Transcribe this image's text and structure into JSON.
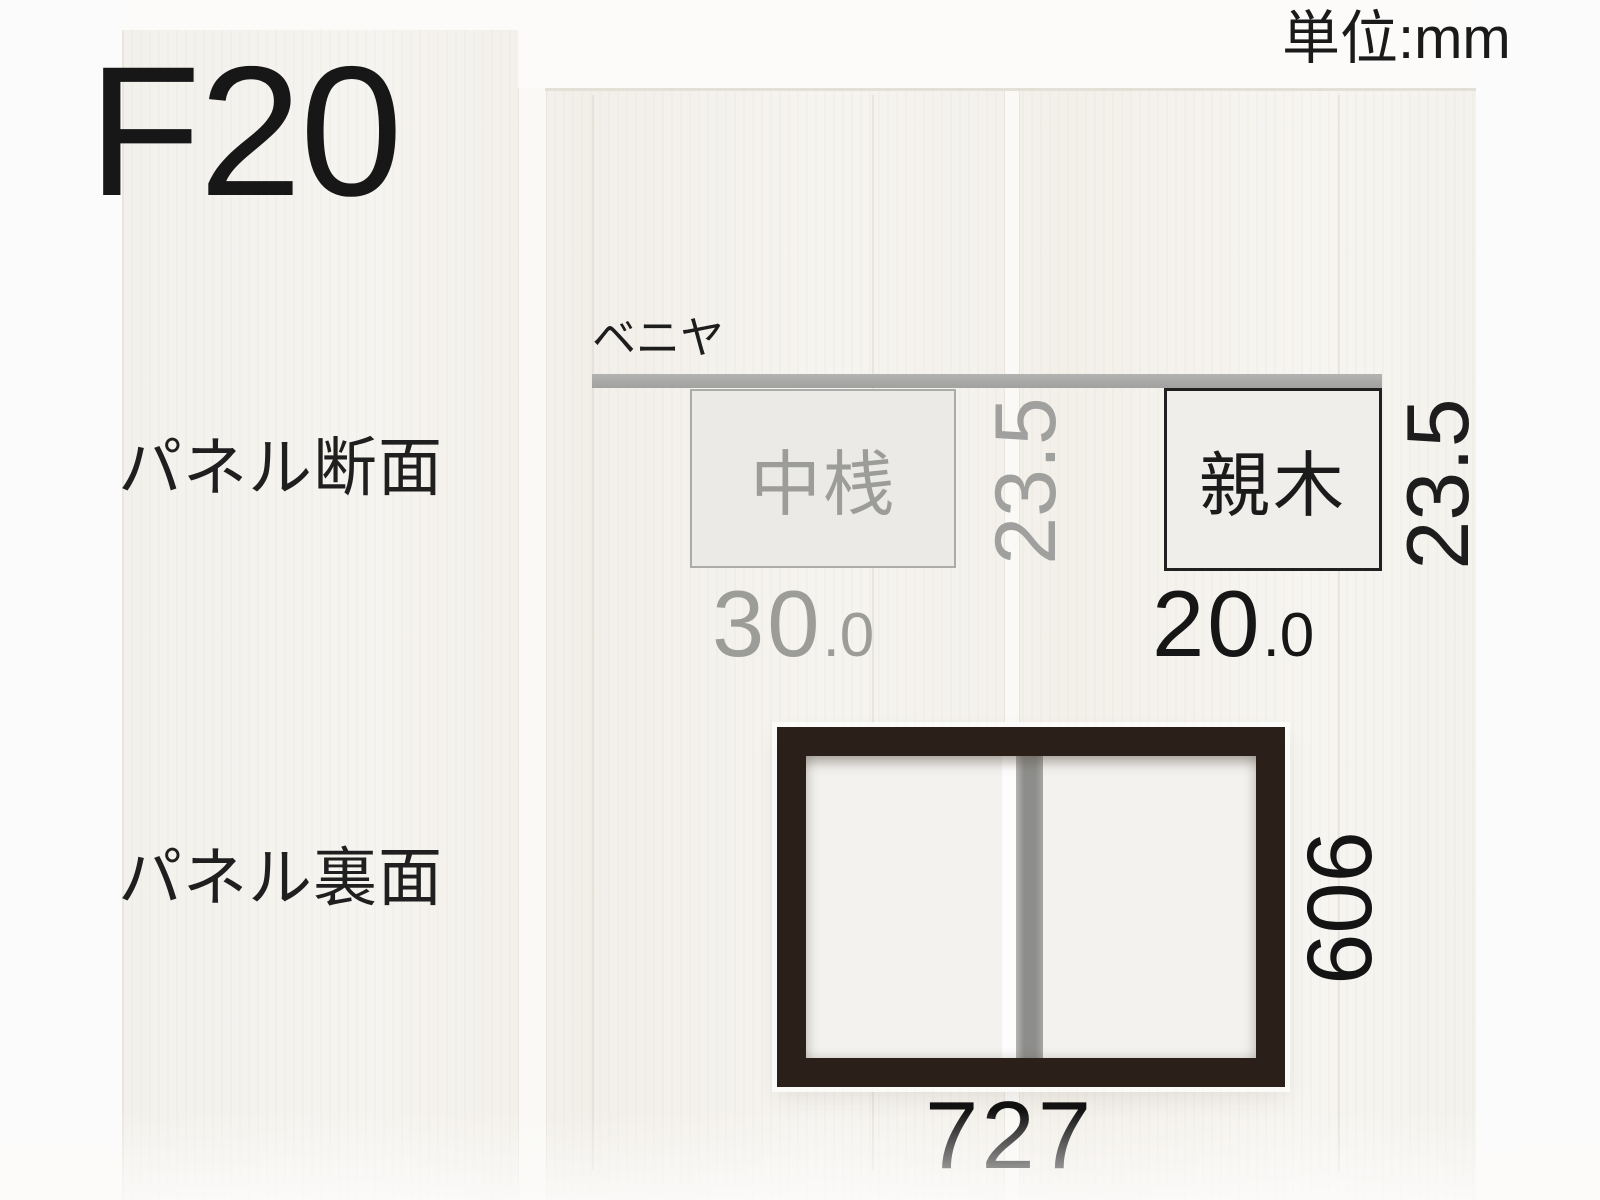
{
  "title": "F20",
  "unit_label": "単位:mm",
  "labels": {
    "cross_section": "パネル断面",
    "back_side": "パネル裏面"
  },
  "cross_section": {
    "plywood_label": "ベニヤ",
    "middle_rail": {
      "label": "中桟",
      "width_int": "30",
      "width_frac": ".0",
      "thickness": "23.5"
    },
    "outer_frame": {
      "label": "親木",
      "width_int": "20",
      "width_frac": ".0",
      "thickness": "23.5"
    }
  },
  "back_view": {
    "width": "727",
    "height": "606"
  },
  "colors": {
    "frame_dark": "#2b1f1a",
    "plywood_gray": "#a8a8a6",
    "dim_gray": "#9c9c99",
    "text_black": "#1c1c1c",
    "wood_bg": "#f4f2ee"
  }
}
